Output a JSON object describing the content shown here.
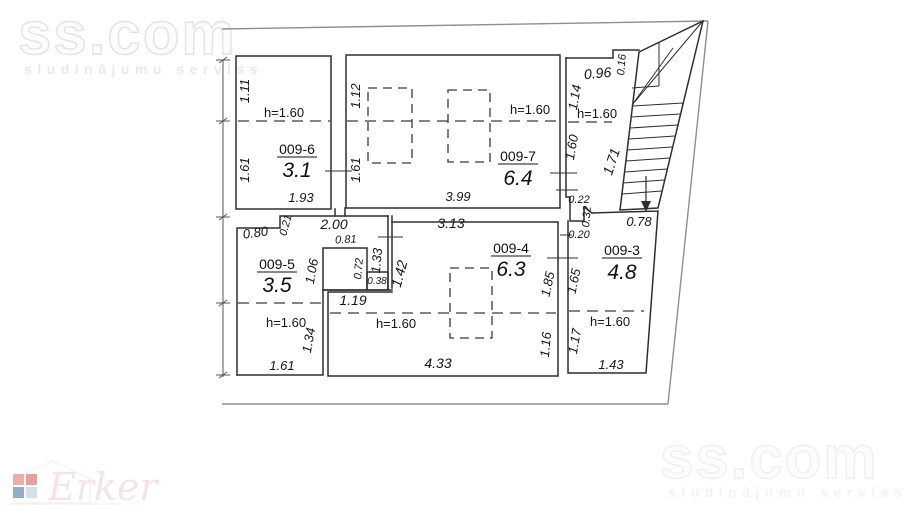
{
  "watermark": {
    "brand": "ss.com",
    "tagline": "sludinājumu serviss"
  },
  "logo": {
    "brand": "Erker"
  },
  "plan": {
    "height_note": "h=1.60",
    "rooms": [
      {
        "code": "009-6",
        "area": "3.1"
      },
      {
        "code": "009-7",
        "area": "6.4"
      },
      {
        "code": "009-5",
        "area": "3.5"
      },
      {
        "code": "009-4",
        "area": "6.3"
      },
      {
        "code": "009-3",
        "area": "4.8"
      }
    ],
    "dims": {
      "r6_side_upper": "1.11",
      "r6_side_lower": "1.61",
      "r6_width": "1.93",
      "r7_side_upper": "1.12",
      "r7_side_lower": "1.61",
      "r7_width": "3.99",
      "hall_width": "0.96",
      "hall_step": "0.16",
      "hall_side_upper": "1.14",
      "hall_side_lower": "1.60",
      "hall_notch_w": "0.22",
      "hall_notch_h": "0.32",
      "stair_length": "1.71",
      "stair_width": "0.78",
      "mid_step": "0.21",
      "mid_width_left": "2.00",
      "mid_width_right": "3.13",
      "mid_left": "0.80",
      "mid_closet": "0.81",
      "mid_wall": "0.20",
      "r5_side": "1.06",
      "closet_inner": "0.72",
      "closet_side": "1.33",
      "closet_gap": "0.38",
      "closet_right": "1.42",
      "r5_ext": "1.19",
      "r5_lower": "1.34",
      "r5_width": "1.61",
      "r4_side_upper": "1.85",
      "r4_side_lower": "1.16",
      "r4_width": "4.33",
      "r3_side_upper": "1.65",
      "r3_side_lower": "1.17",
      "r3_width": "1.43"
    }
  }
}
